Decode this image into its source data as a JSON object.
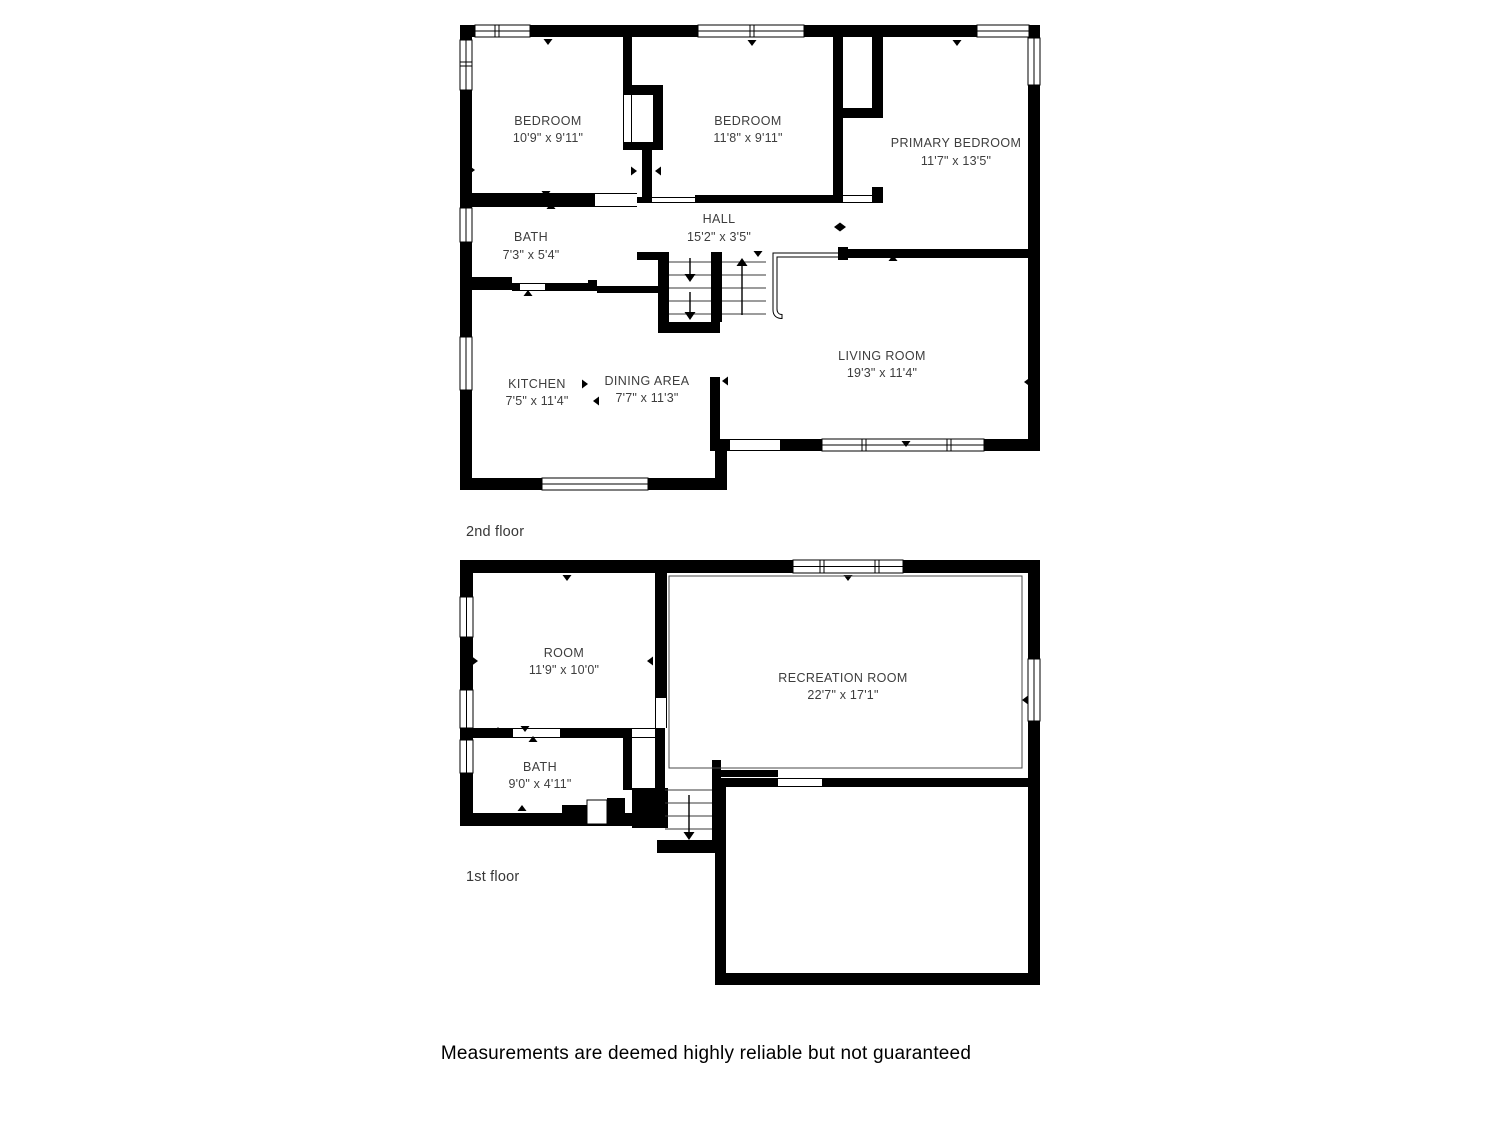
{
  "document": {
    "type": "floor-plan",
    "disclaimer": "Measurements are deemed highly reliable but not guaranteed"
  },
  "colors": {
    "wall": "#000000",
    "label_text": "#3d3d3d",
    "background": "#ffffff"
  },
  "floors": [
    {
      "caption": "2nd floor",
      "rooms": [
        {
          "label": "BEDROOM",
          "dims": "10'9\" x 9'11\""
        },
        {
          "label": "BEDROOM",
          "dims": "11'8\" x 9'11\""
        },
        {
          "label": "PRIMARY BEDROOM",
          "dims": "11'7\" x 13'5\""
        },
        {
          "label": "BATH",
          "dims": "7'3\" x 5'4\""
        },
        {
          "label": "HALL",
          "dims": "15'2\" x 3'5\""
        },
        {
          "label": "KITCHEN",
          "dims": "7'5\" x 11'4\""
        },
        {
          "label": "DINING AREA",
          "dims": "7'7\" x 11'3\""
        },
        {
          "label": "LIVING ROOM",
          "dims": "19'3\" x 11'4\""
        }
      ]
    },
    {
      "caption": "1st floor",
      "rooms": [
        {
          "label": "ROOM",
          "dims": "11'9\" x 10'0\""
        },
        {
          "label": "RECREATION ROOM",
          "dims": "22'7\" x 17'1\""
        },
        {
          "label": "BATH",
          "dims": "9'0\" x 4'11\""
        }
      ]
    }
  ]
}
